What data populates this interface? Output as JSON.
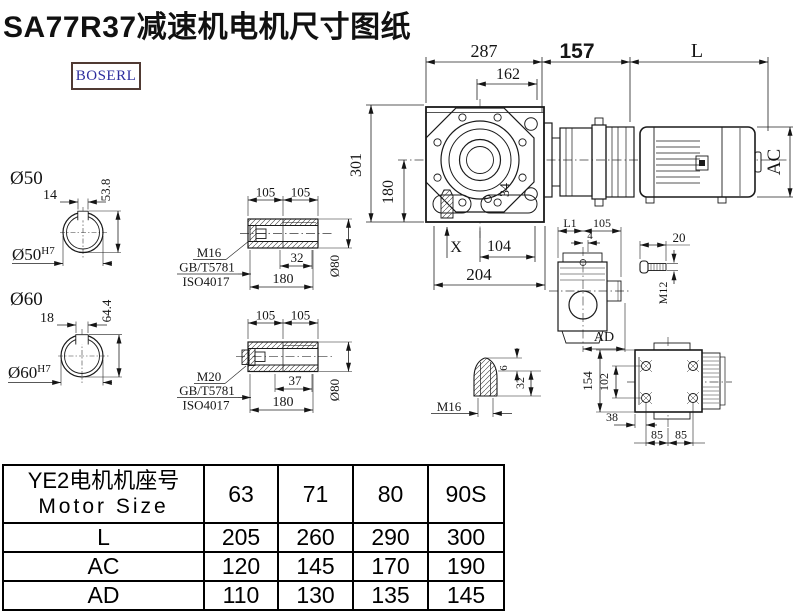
{
  "title": "SA77R37减速机电机尺寸图纸",
  "logo": {
    "text": "BOSERL"
  },
  "colors": {
    "line": "#1a1a1a",
    "logo_text": "#2d2d9e",
    "logo_border": "#503a33"
  },
  "main_view": {
    "dim_287": "287",
    "dim_162": "162",
    "dim_157": "157",
    "dim_L": "L",
    "dim_AC": "AC",
    "dim_301": "301",
    "dim_180": "180",
    "dim_34": "34",
    "dim_X": "X",
    "dim_104": "104",
    "dim_204": "204"
  },
  "shaft_sections": {
    "s50": {
      "label": "Ø50",
      "bore_label": "Ø50",
      "bore_tol": "H7",
      "key_width": "14",
      "height": "53.8"
    },
    "s60": {
      "label": "Ø60",
      "bore_label": "Ø60",
      "bore_tol": "H7",
      "key_width": "18",
      "height": "64.4"
    }
  },
  "hollow_shaft_1": {
    "dim_105a": "105",
    "dim_105b": "105",
    "dim_32": "32",
    "dim_180": "180",
    "dim_d80": "Ø80",
    "thread": "M16",
    "standard_gb": "GB/T5781",
    "standard_iso": "ISO4017"
  },
  "hollow_shaft_2": {
    "dim_105a": "105",
    "dim_105b": "105",
    "dim_37": "37",
    "dim_180": "180",
    "dim_d80": "Ø80",
    "thread": "M20",
    "standard_gb": "GB/T5781",
    "standard_iso": "ISO4017"
  },
  "side_view": {
    "dim_L1": "L1",
    "dim_105": "105",
    "dim_4": "4",
    "dim_AD": "AD"
  },
  "bolt_detail": {
    "dim_20": "20",
    "thread": "M12"
  },
  "plug_detail": {
    "thread": "M16",
    "dim_6": "6",
    "dim_32": "32"
  },
  "top_view": {
    "dim_154": "154",
    "dim_102": "102",
    "dim_38": "38",
    "dim_85a": "85",
    "dim_85b": "85"
  },
  "table": {
    "header_cn": "YE2电机机座号",
    "header_en": "Motor Size",
    "sizes": [
      "63",
      "71",
      "80",
      "90S"
    ],
    "rows": [
      {
        "label": "L",
        "values": [
          "205",
          "260",
          "290",
          "300"
        ]
      },
      {
        "label": "AC",
        "values": [
          "120",
          "145",
          "170",
          "190"
        ]
      },
      {
        "label": "AD",
        "values": [
          "110",
          "130",
          "135",
          "145"
        ]
      }
    ]
  }
}
